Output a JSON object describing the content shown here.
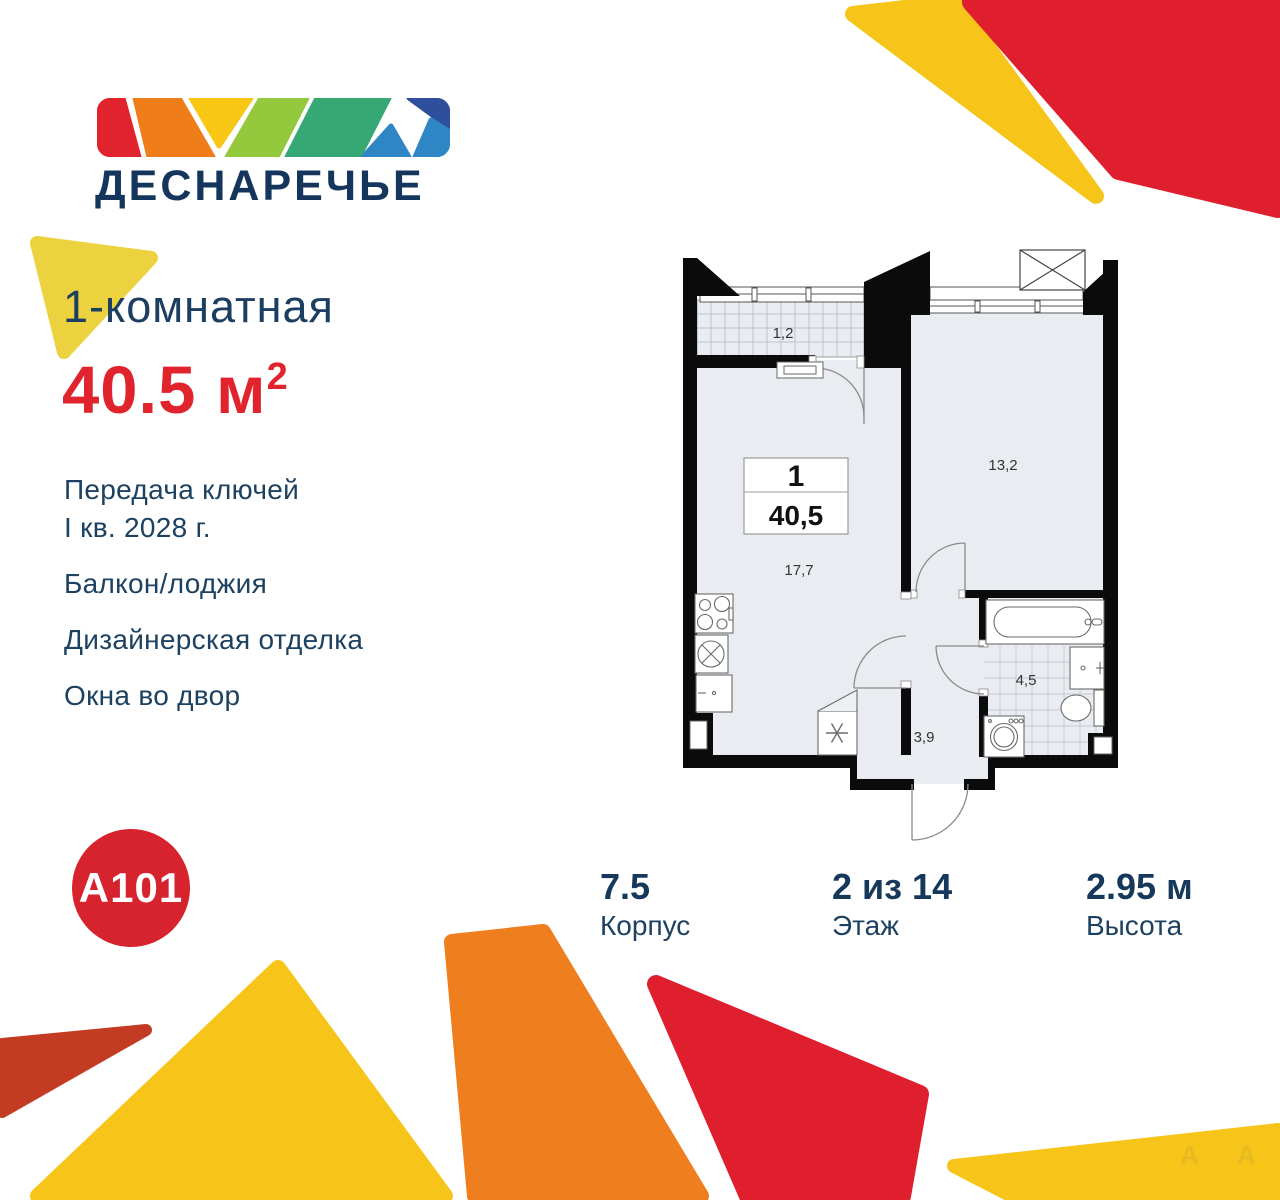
{
  "brand": {
    "project_name": "ДЕСНАРЕЧЬЕ",
    "developer": "A101"
  },
  "listing": {
    "type_title": "1-комнатная",
    "area_value": "40.5",
    "area_unit": "м",
    "area_superscript": "2",
    "features": [
      "Передача ключей",
      "I кв. 2028 г.",
      "Балкон/лоджия",
      "Дизайнерская отделка",
      "Окна во двор"
    ]
  },
  "floor_plan": {
    "unit_badge": {
      "rooms": "1",
      "area": "40,5"
    },
    "room_areas": {
      "balcony": "1,2",
      "bedroom": "13,2",
      "kitchen_living": "17,7",
      "bathroom": "4,5",
      "hallway": "3,9"
    }
  },
  "stats": [
    {
      "value": "7.5",
      "label": "Корпус"
    },
    {
      "value": "2 из 14",
      "label": "Этаж"
    },
    {
      "value": "2.95 м",
      "label": "Высота"
    }
  ],
  "watermark": "A",
  "colors": {
    "navy": "#16395c",
    "area_red": "#e0232d",
    "decor_red": "#e01f2e",
    "decor_dark_red": "#c23b22",
    "decor_orange": "#ee7e1e",
    "decor_yellow": "#f7c51a",
    "decor_gold": "#ecd23f",
    "a101_red": "#d6232e",
    "plan_floor": "#e9edf1",
    "plan_wall": "#0b0b0b",
    "logo_band": [
      "#e0232d",
      "#ef7d1a",
      "#f8c713",
      "#95c93d",
      "#35a874",
      "#2e86c5",
      "#2d4f9c",
      "#2e86c5"
    ]
  }
}
